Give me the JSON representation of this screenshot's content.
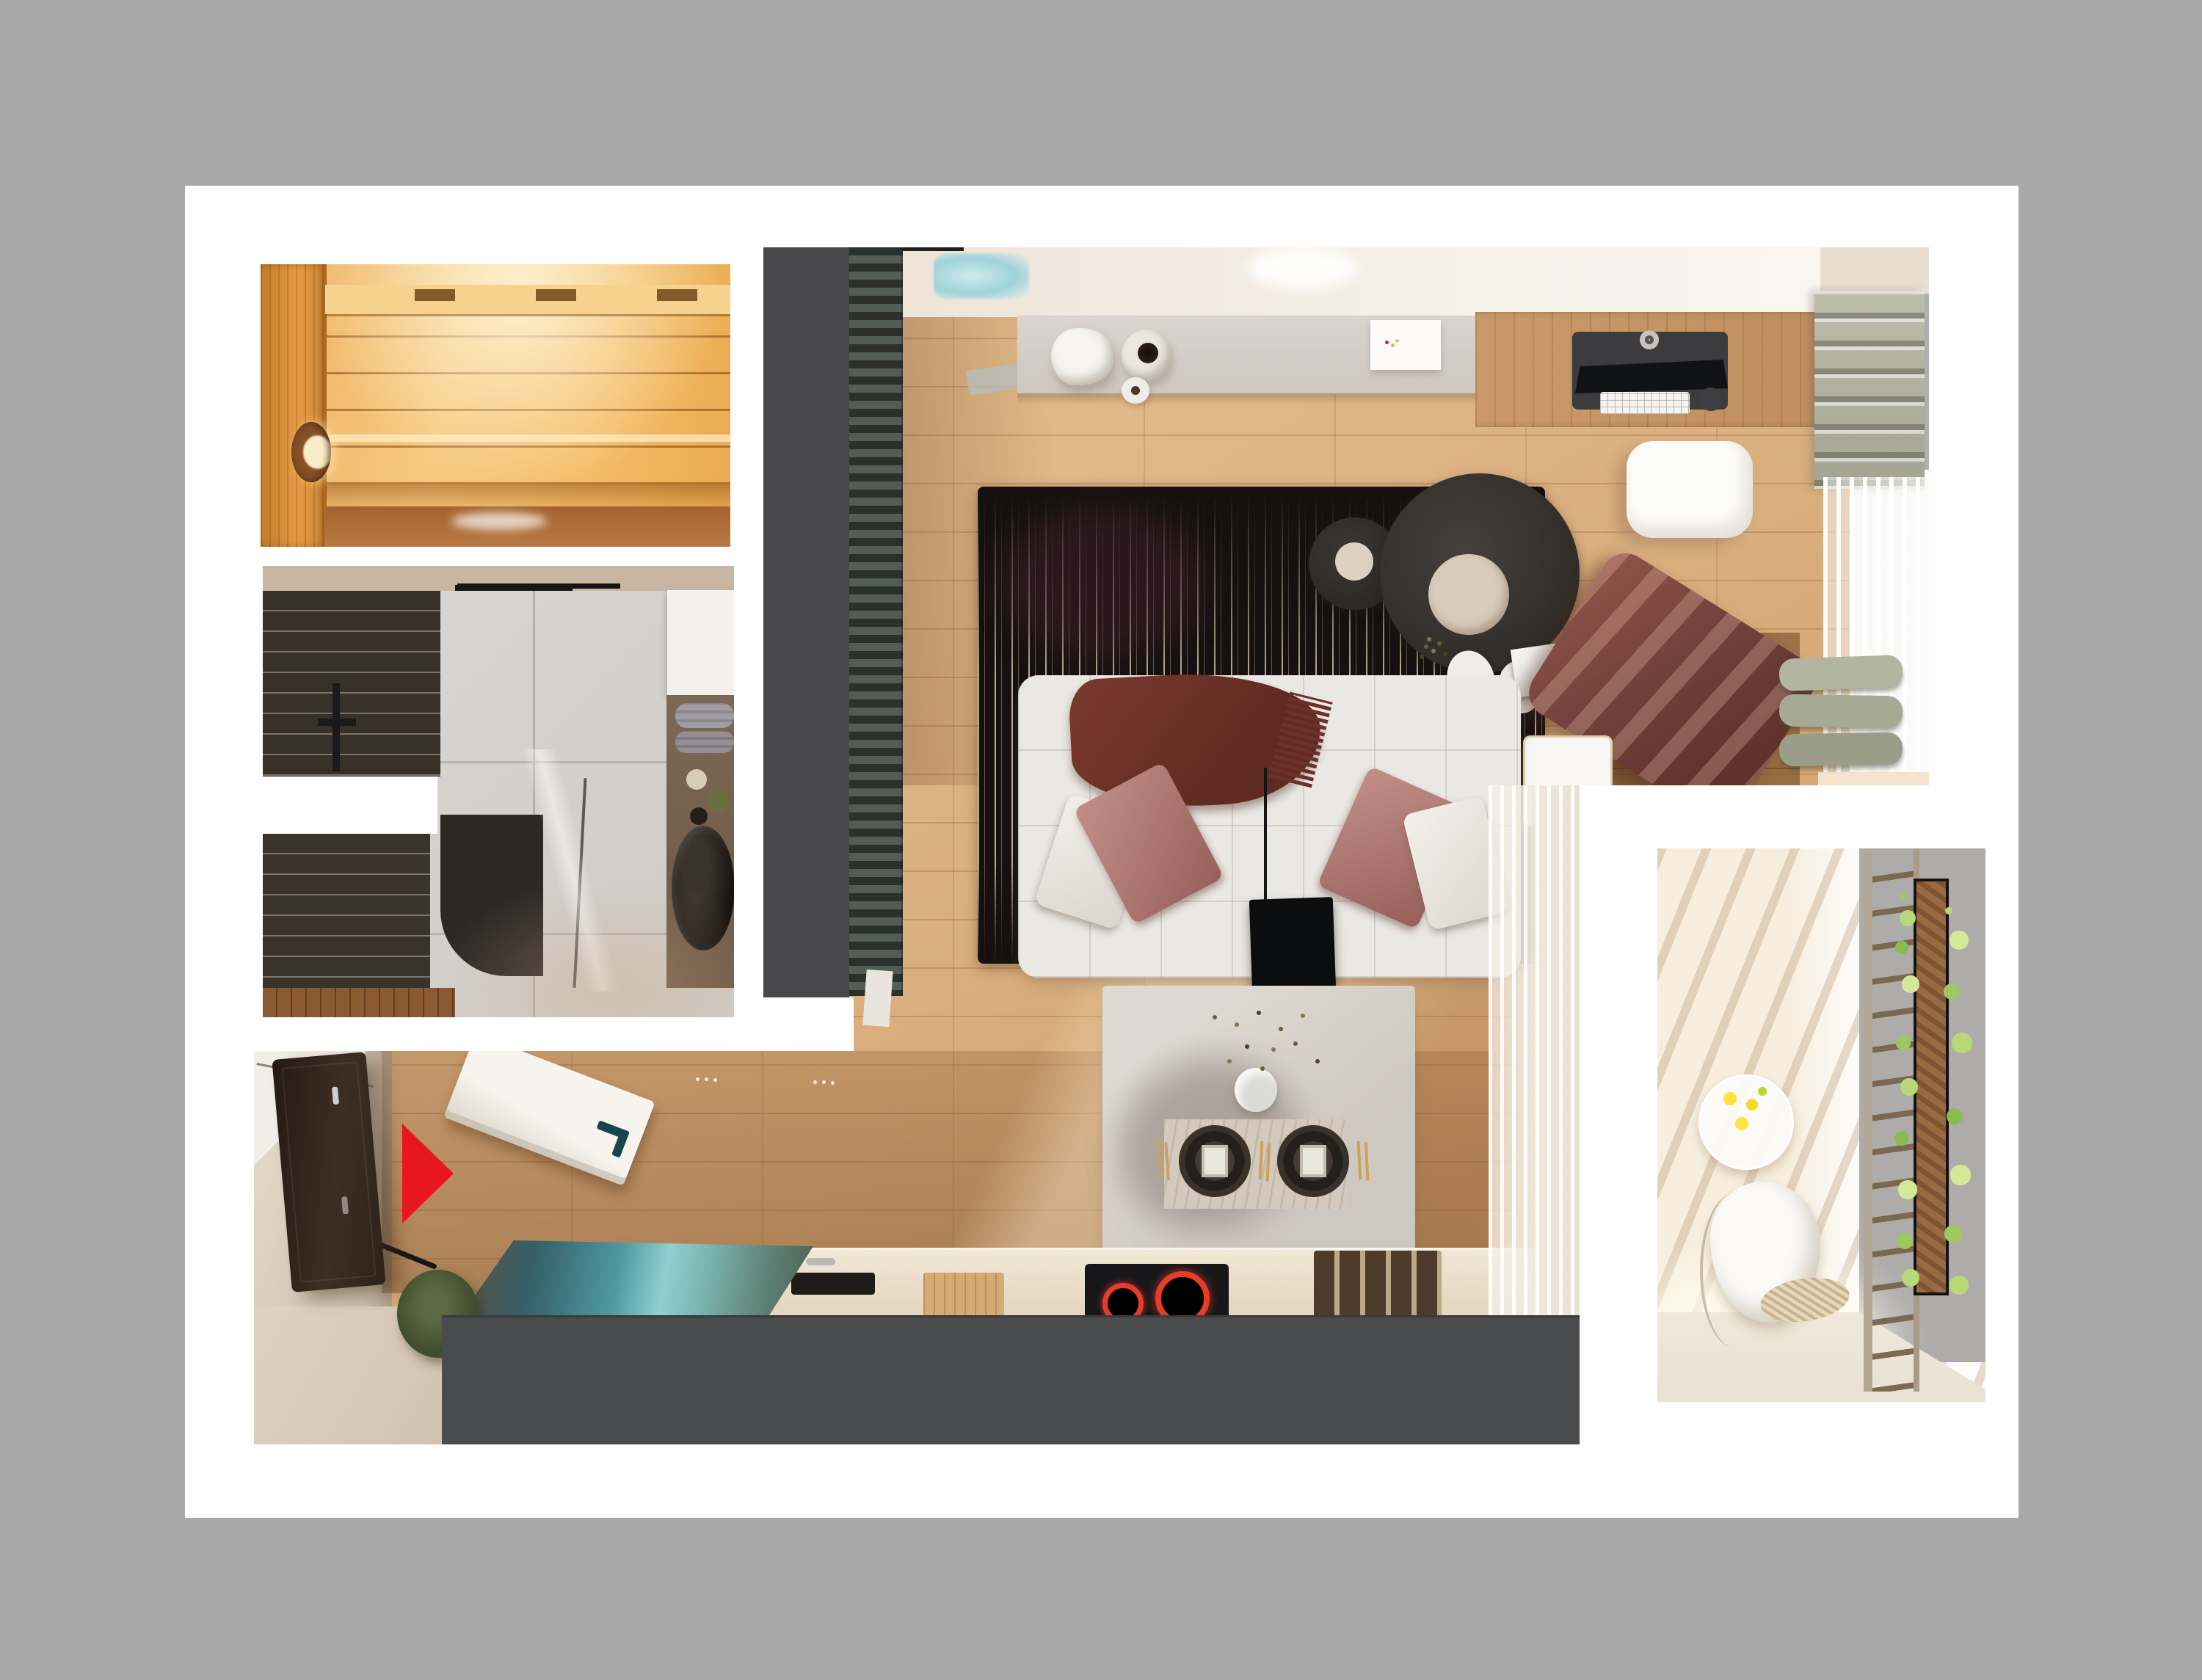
{
  "scene": {
    "background_color": "#a8a8a8",
    "page_color": "#ffffff",
    "view": "top-down apartment interior render collage"
  },
  "markers": {
    "entrance_arrow_color": "#e8161f"
  },
  "palette": {
    "sauna_wood": "#f2bd6a",
    "sauna_wood_dark": "#cf8833",
    "bath_tile_dark": "#38312a",
    "bath_marble": "#d7d4d0",
    "wall_dark_gray": "#48484a",
    "island_dark_gray": "#4a4b4d",
    "floor_wood": "#ddb282",
    "entry_wood": "#a87a50",
    "rug_black": "#161110",
    "sofa_white": "#eae8e3",
    "pillow_mauve": "#b07a74",
    "throw_burgundy": "#6b3129",
    "chaise_mauve": "#71403a",
    "roman_shade_sage": "#b0b19e",
    "bench_cushion_sage": "#a8ab97",
    "kitchen_table_teal": "#4f98a0",
    "cooktop_ring_red": "#e63c28",
    "door_handle_teal": "#17454e",
    "balcony_wall": "#f7eede",
    "plant_green": "#9cc85e",
    "ceiling_cream": "#f2ebe1",
    "skylight_blue": "#a8d8de",
    "dining_table_gray": "#d5cec7",
    "console_gray": "#d5cfc9",
    "desk_wood": "#c9996a"
  },
  "regions": [
    {
      "id": "sauna-photo",
      "label": "sauna interior inset"
    },
    {
      "id": "bathroom-photo",
      "label": "shower room inset"
    },
    {
      "id": "entry-area",
      "label": "entry hall with entrance arrow and open door"
    },
    {
      "id": "living-area",
      "label": "living room with sofa, rug, coffee tables, TV console, desk"
    },
    {
      "id": "dining-kitchen",
      "label": "dining table, chairs, kitchen counters with cooktop and sink"
    },
    {
      "id": "balcony-photo",
      "label": "balcony with hanging chair, trellis and planter"
    }
  ]
}
